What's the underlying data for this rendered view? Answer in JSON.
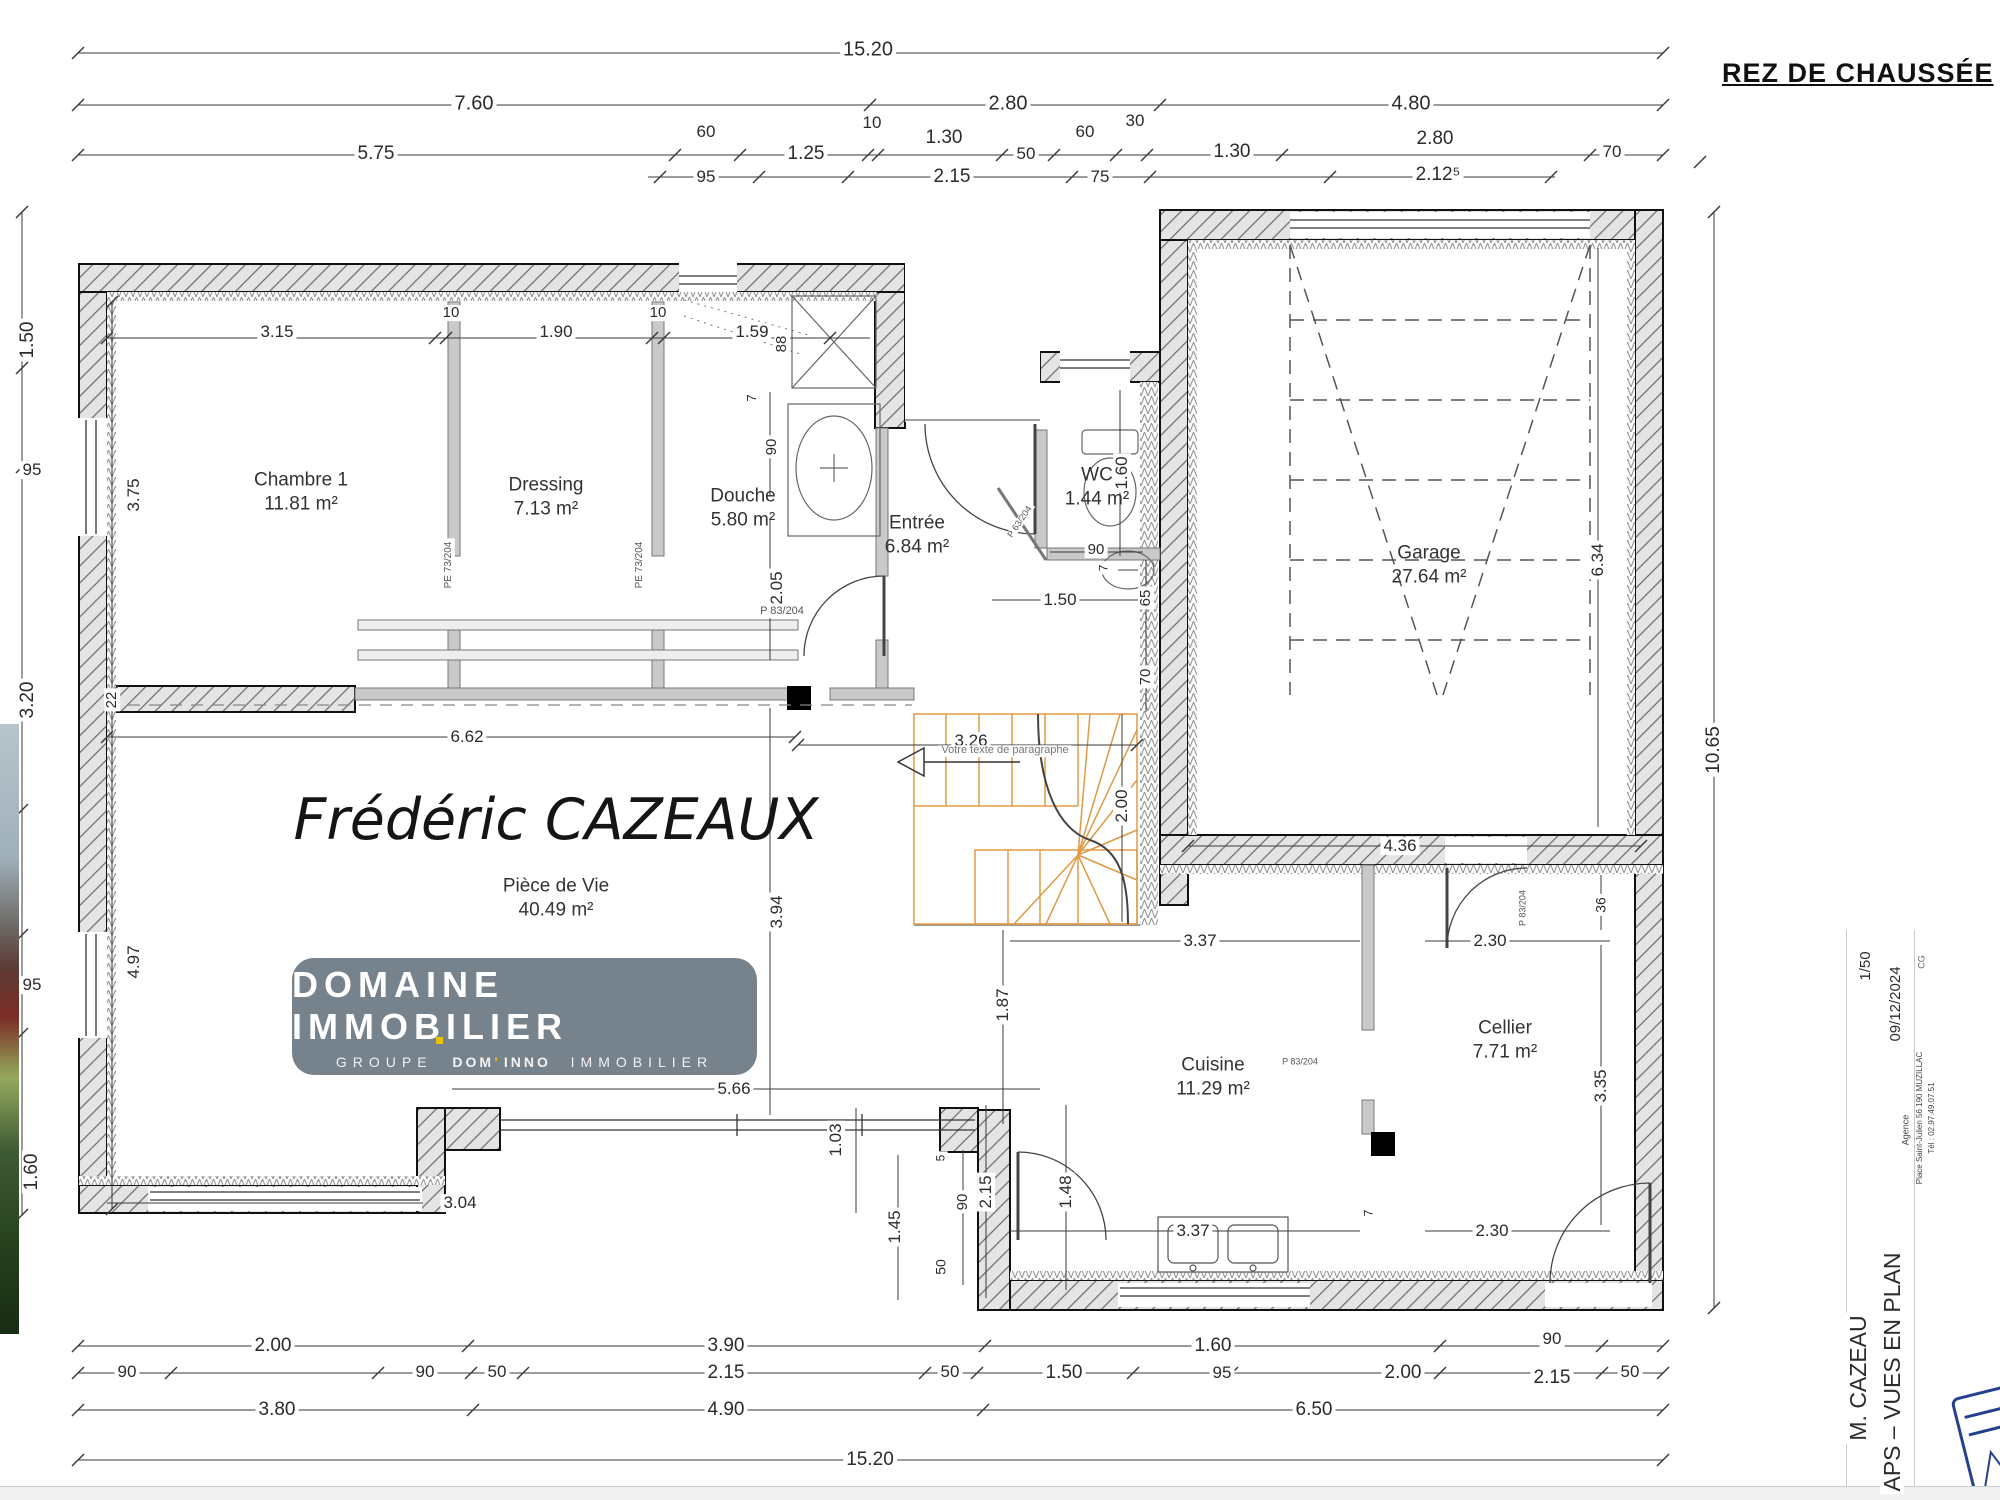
{
  "page_title": "REZ DE CHAUSSÉE",
  "watermark_name": "Frédéric CAZEAUX",
  "stair_note": "Votre texte de paragraphe",
  "logo": {
    "line1": "DOMAINE IMMOBILIER",
    "groupe": "GROUPE",
    "dom": "DOM",
    "apos": "’",
    "inno": "INNO",
    "immobilier": "IMMOBILIER",
    "bg_color": "#76828c",
    "accent_color": "#e8c400"
  },
  "stair_color": "#e09a45",
  "rooms": [
    {
      "n": "room-chambre-1",
      "name": "Chambre 1",
      "area": "11.81 m²",
      "x": 301,
      "y": 492
    },
    {
      "n": "room-dressing",
      "name": "Dressing",
      "area": "7.13 m²",
      "x": 546,
      "y": 497
    },
    {
      "n": "room-douche",
      "name": "Douche",
      "area": "5.80 m²",
      "x": 743,
      "y": 508
    },
    {
      "n": "room-entree",
      "name": "Entrée",
      "area": "6.84 m²",
      "x": 917,
      "y": 535
    },
    {
      "n": "room-wc",
      "name": "WC",
      "area": "1.44 m²",
      "x": 1097,
      "y": 487
    },
    {
      "n": "room-garage",
      "name": "Garage",
      "area": "27.64 m²",
      "x": 1429,
      "y": 565
    },
    {
      "n": "room-piece-de-vie",
      "name": "Pièce de Vie",
      "area": "40.49 m²",
      "x": 556,
      "y": 898
    },
    {
      "n": "room-cuisine",
      "name": "Cuisine",
      "area": "11.29 m²",
      "x": 1213,
      "y": 1077
    },
    {
      "n": "room-cellier",
      "name": "Cellier",
      "area": "7.71 m²",
      "x": 1505,
      "y": 1040
    }
  ],
  "dim_labels": [
    {
      "n": "dim-top-total",
      "t": "15.20",
      "x": 868,
      "y": 50,
      "s": 20
    },
    {
      "n": "dim",
      "t": "7.60",
      "x": 474,
      "y": 104,
      "s": 20
    },
    {
      "n": "dim",
      "t": "2.80",
      "x": 1008,
      "y": 104,
      "s": 20
    },
    {
      "n": "dim",
      "t": "4.80",
      "x": 1411,
      "y": 104,
      "s": 20
    },
    {
      "n": "dim",
      "t": "5.75",
      "x": 376,
      "y": 154
    },
    {
      "n": "dim",
      "t": "60",
      "x": 706,
      "y": 132,
      "s": 17
    },
    {
      "n": "dim",
      "t": "1.25",
      "x": 806,
      "y": 154
    },
    {
      "n": "dim",
      "t": "10",
      "x": 872,
      "y": 123,
      "s": 17
    },
    {
      "n": "dim",
      "t": "1.30",
      "x": 944,
      "y": 138
    },
    {
      "n": "dim",
      "t": "50",
      "x": 1026,
      "y": 154,
      "s": 17
    },
    {
      "n": "dim",
      "t": "60",
      "x": 1085,
      "y": 132,
      "s": 17
    },
    {
      "n": "dim",
      "t": "30",
      "x": 1135,
      "y": 121,
      "s": 17
    },
    {
      "n": "dim",
      "t": "1.30",
      "x": 1232,
      "y": 152
    },
    {
      "n": "dim",
      "t": "2.80",
      "x": 1435,
      "y": 139
    },
    {
      "n": "dim",
      "t": "70",
      "x": 1612,
      "y": 152,
      "s": 17
    },
    {
      "n": "dim",
      "t": "95",
      "x": 706,
      "y": 177,
      "s": 17
    },
    {
      "n": "dim",
      "t": "2.15",
      "x": 952,
      "y": 177
    },
    {
      "n": "dim",
      "t": "75",
      "x": 1100,
      "y": 177,
      "s": 17
    },
    {
      "n": "dim",
      "t": "2.12⁵",
      "x": 1438,
      "y": 175
    },
    {
      "n": "dim",
      "t": "1.50",
      "x": 28,
      "y": 340,
      "r": -90
    },
    {
      "n": "dim",
      "t": "95",
      "x": 32,
      "y": 470,
      "s": 17
    },
    {
      "n": "dim",
      "t": "3.20",
      "x": 28,
      "y": 700,
      "r": -90
    },
    {
      "n": "dim",
      "t": "95",
      "x": 32,
      "y": 985,
      "s": 17
    },
    {
      "n": "dim",
      "t": "1.60",
      "x": 32,
      "y": 1172,
      "r": -90
    },
    {
      "n": "dim",
      "t": "3.75",
      "x": 134,
      "y": 495,
      "s": 17,
      "r": -90
    },
    {
      "n": "dim",
      "t": "22",
      "x": 112,
      "y": 700,
      "s": 15,
      "r": -90
    },
    {
      "n": "dim",
      "t": "4.97",
      "x": 134,
      "y": 962,
      "s": 17,
      "r": -90
    },
    {
      "n": "dim",
      "t": "3.15",
      "x": 277,
      "y": 332,
      "s": 17
    },
    {
      "n": "dim",
      "t": "10",
      "x": 451,
      "y": 313,
      "s": 15
    },
    {
      "n": "dim",
      "t": "1.90",
      "x": 556,
      "y": 332,
      "s": 17
    },
    {
      "n": "dim",
      "t": "10",
      "x": 658,
      "y": 313,
      "s": 15
    },
    {
      "n": "dim",
      "t": "1.59",
      "x": 752,
      "y": 332,
      "s": 17
    },
    {
      "n": "dim",
      "t": "88",
      "x": 782,
      "y": 344,
      "s": 15,
      "r": -90
    },
    {
      "n": "dim",
      "t": "7",
      "x": 752,
      "y": 398,
      "s": 13,
      "r": -90
    },
    {
      "n": "dim",
      "t": "90",
      "x": 772,
      "y": 447,
      "s": 15,
      "r": -90
    },
    {
      "n": "dim",
      "t": "2.05",
      "x": 777,
      "y": 588,
      "s": 17,
      "r": -90
    },
    {
      "n": "door-label",
      "t": "P 83/204",
      "x": 782,
      "y": 612,
      "s": 11,
      "c": "#555"
    },
    {
      "n": "door-label",
      "t": "PE 73/204",
      "x": 449,
      "y": 565,
      "s": 10,
      "r": -90,
      "c": "#555"
    },
    {
      "n": "door-label",
      "t": "PE 73/204",
      "x": 640,
      "y": 565,
      "s": 10,
      "r": -90,
      "c": "#555"
    },
    {
      "n": "dim",
      "t": "1.60",
      "x": 1122,
      "y": 473,
      "s": 17,
      "r": -90
    },
    {
      "n": "dim",
      "t": "90",
      "x": 1096,
      "y": 550,
      "s": 15
    },
    {
      "n": "dim",
      "t": "7",
      "x": 1104,
      "y": 568,
      "s": 12,
      "r": -90
    },
    {
      "n": "dim",
      "t": "1.50",
      "x": 1060,
      "y": 600,
      "s": 17
    },
    {
      "n": "dim",
      "t": "65",
      "x": 1146,
      "y": 598,
      "s": 15,
      "r": -90
    },
    {
      "n": "dim",
      "t": "70",
      "x": 1146,
      "y": 677,
      "s": 15,
      "r": -90
    },
    {
      "n": "door-label",
      "t": "P 63/204",
      "x": 1020,
      "y": 522,
      "s": 9,
      "r": -56,
      "c": "#555"
    },
    {
      "n": "dim",
      "t": "6.62",
      "x": 467,
      "y": 737,
      "s": 17
    },
    {
      "n": "dim",
      "t": "3.26",
      "x": 971,
      "y": 741,
      "s": 17
    },
    {
      "n": "stair-note",
      "t": "Votre texte de paragraphe",
      "x": 1005,
      "y": 751,
      "s": 11,
      "c": "#777"
    },
    {
      "n": "dim",
      "t": "2.00",
      "x": 1122,
      "y": 806,
      "s": 17,
      "r": -90
    },
    {
      "n": "dim",
      "t": "3.94",
      "x": 777,
      "y": 912,
      "s": 17,
      "r": -90
    },
    {
      "n": "dim",
      "t": "6.34",
      "x": 1598,
      "y": 560,
      "s": 17,
      "r": -90
    },
    {
      "n": "dim",
      "t": "10.65",
      "x": 1714,
      "y": 750,
      "s": 19,
      "r": -90
    },
    {
      "n": "dim",
      "t": "36",
      "x": 1601,
      "y": 905,
      "s": 14,
      "r": -90
    },
    {
      "n": "dim",
      "t": "3.35",
      "x": 1601,
      "y": 1086,
      "s": 17,
      "r": -90
    },
    {
      "n": "dim",
      "t": "4.36",
      "x": 1400,
      "y": 846,
      "s": 17
    },
    {
      "n": "dim",
      "t": "3.37",
      "x": 1200,
      "y": 941,
      "s": 17
    },
    {
      "n": "dim",
      "t": "2.30",
      "x": 1490,
      "y": 941,
      "s": 17
    },
    {
      "n": "door-label",
      "t": "P 83/204",
      "x": 1523,
      "y": 908,
      "s": 9,
      "r": -90,
      "c": "#555"
    },
    {
      "n": "dim",
      "t": "1.87",
      "x": 1003,
      "y": 1005,
      "s": 17,
      "r": -90
    },
    {
      "n": "door-label",
      "t": "P 83/204",
      "x": 1300,
      "y": 1062,
      "s": 9,
      "c": "#555"
    },
    {
      "n": "dim",
      "t": "7",
      "x": 1369,
      "y": 1213,
      "s": 12,
      "r": -90
    },
    {
      "n": "dim",
      "t": "5.66",
      "x": 734,
      "y": 1089,
      "s": 17
    },
    {
      "n": "dim",
      "t": "1.03",
      "x": 836,
      "y": 1140,
      "s": 17,
      "r": -90
    },
    {
      "n": "dim",
      "t": "3.04",
      "x": 460,
      "y": 1203,
      "s": 17
    },
    {
      "n": "dim",
      "t": "1.45",
      "x": 895,
      "y": 1227,
      "s": 17,
      "r": -90
    },
    {
      "n": "dim",
      "t": "5",
      "x": 941,
      "y": 1158,
      "s": 12,
      "r": -90
    },
    {
      "n": "dim",
      "t": "90",
      "x": 963,
      "y": 1202,
      "s": 15,
      "r": -90
    },
    {
      "n": "dim",
      "t": "2.15",
      "x": 986,
      "y": 1192,
      "s": 17,
      "r": -90
    },
    {
      "n": "dim",
      "t": "50",
      "x": 941,
      "y": 1267,
      "s": 14,
      "r": -90
    },
    {
      "n": "dim",
      "t": "1.48",
      "x": 1066,
      "y": 1192,
      "s": 17,
      "r": -90
    },
    {
      "n": "dim",
      "t": "3.37",
      "x": 1193,
      "y": 1231,
      "s": 17
    },
    {
      "n": "dim",
      "t": "2.30",
      "x": 1492,
      "y": 1231,
      "s": 17
    },
    {
      "n": "dim",
      "t": "2.00",
      "x": 273,
      "y": 1346,
      "s": 19
    },
    {
      "n": "dim",
      "t": "3.90",
      "x": 726,
      "y": 1346,
      "s": 19
    },
    {
      "n": "dim",
      "t": "1.60",
      "x": 1213,
      "y": 1346,
      "s": 19
    },
    {
      "n": "dim",
      "t": "90",
      "x": 1552,
      "y": 1339,
      "s": 17
    },
    {
      "n": "dim",
      "t": "90",
      "x": 127,
      "y": 1372,
      "s": 17
    },
    {
      "n": "dim",
      "t": "90",
      "x": 425,
      "y": 1372,
      "s": 17
    },
    {
      "n": "dim",
      "t": "50",
      "x": 497,
      "y": 1372,
      "s": 17
    },
    {
      "n": "dim",
      "t": "2.15",
      "x": 726,
      "y": 1373,
      "s": 19
    },
    {
      "n": "dim",
      "t": "50",
      "x": 950,
      "y": 1372,
      "s": 17
    },
    {
      "n": "dim",
      "t": "1.50",
      "x": 1064,
      "y": 1373,
      "s": 19
    },
    {
      "n": "dim",
      "t": "95",
      "x": 1222,
      "y": 1373,
      "s": 17
    },
    {
      "n": "dim",
      "t": "2.00",
      "x": 1403,
      "y": 1373,
      "s": 19
    },
    {
      "n": "dim",
      "t": "2.15",
      "x": 1552,
      "y": 1378,
      "s": 19
    },
    {
      "n": "dim",
      "t": "50",
      "x": 1630,
      "y": 1372,
      "s": 17
    },
    {
      "n": "dim",
      "t": "3.80",
      "x": 277,
      "y": 1410,
      "s": 19
    },
    {
      "n": "dim",
      "t": "4.90",
      "x": 726,
      "y": 1410,
      "s": 19
    },
    {
      "n": "dim",
      "t": "6.50",
      "x": 1314,
      "y": 1410,
      "s": 19
    },
    {
      "n": "dim-bottom-total",
      "t": "15.20",
      "x": 870,
      "y": 1460,
      "s": 19
    }
  ],
  "title_block": {
    "scale": "1/50",
    "date": "09/12/2024",
    "initials": "CG",
    "agency_label": "Agence",
    "agency_address": "Place Saint-Julien 56 190 MUZILLAC",
    "agency_phone": "Tél : 02.97.49.07.51",
    "client": "M. CAZEAU",
    "doc_type": "APS – VUES EN PLAN",
    "items": [
      {
        "n": "titleblock-scale",
        "t": "1/50",
        "x": 1866,
        "y": 966,
        "s": 15,
        "r": -90
      },
      {
        "n": "titleblock-date",
        "t": "09/12/2024",
        "x": 1896,
        "y": 1004,
        "s": 15,
        "r": -90
      },
      {
        "n": "titleblock-initials",
        "t": "CG",
        "x": 1922,
        "y": 962,
        "s": 9,
        "r": -90,
        "c": "#666"
      },
      {
        "n": "titleblock-agency-label",
        "t": "Agence",
        "x": 1906,
        "y": 1130,
        "s": 9,
        "r": -90,
        "c": "#444"
      },
      {
        "n": "titleblock-agency-address",
        "t": "Place Saint-Julien 56 190 MUZILLAC",
        "x": 1920,
        "y": 1118,
        "s": 8,
        "r": -90,
        "c": "#444"
      },
      {
        "n": "titleblock-agency-phone",
        "t": "Tél : 02.97.49.07.51",
        "x": 1932,
        "y": 1118,
        "s": 8,
        "r": -90,
        "c": "#444"
      },
      {
        "n": "titleblock-client",
        "t": "M. CAZEAU",
        "x": 1858,
        "y": 1378,
        "s": 23,
        "r": -90
      },
      {
        "n": "titleblock-doctype",
        "t": "APS – VUES EN PLAN",
        "x": 1892,
        "y": 1372,
        "s": 23,
        "r": -90
      }
    ]
  }
}
